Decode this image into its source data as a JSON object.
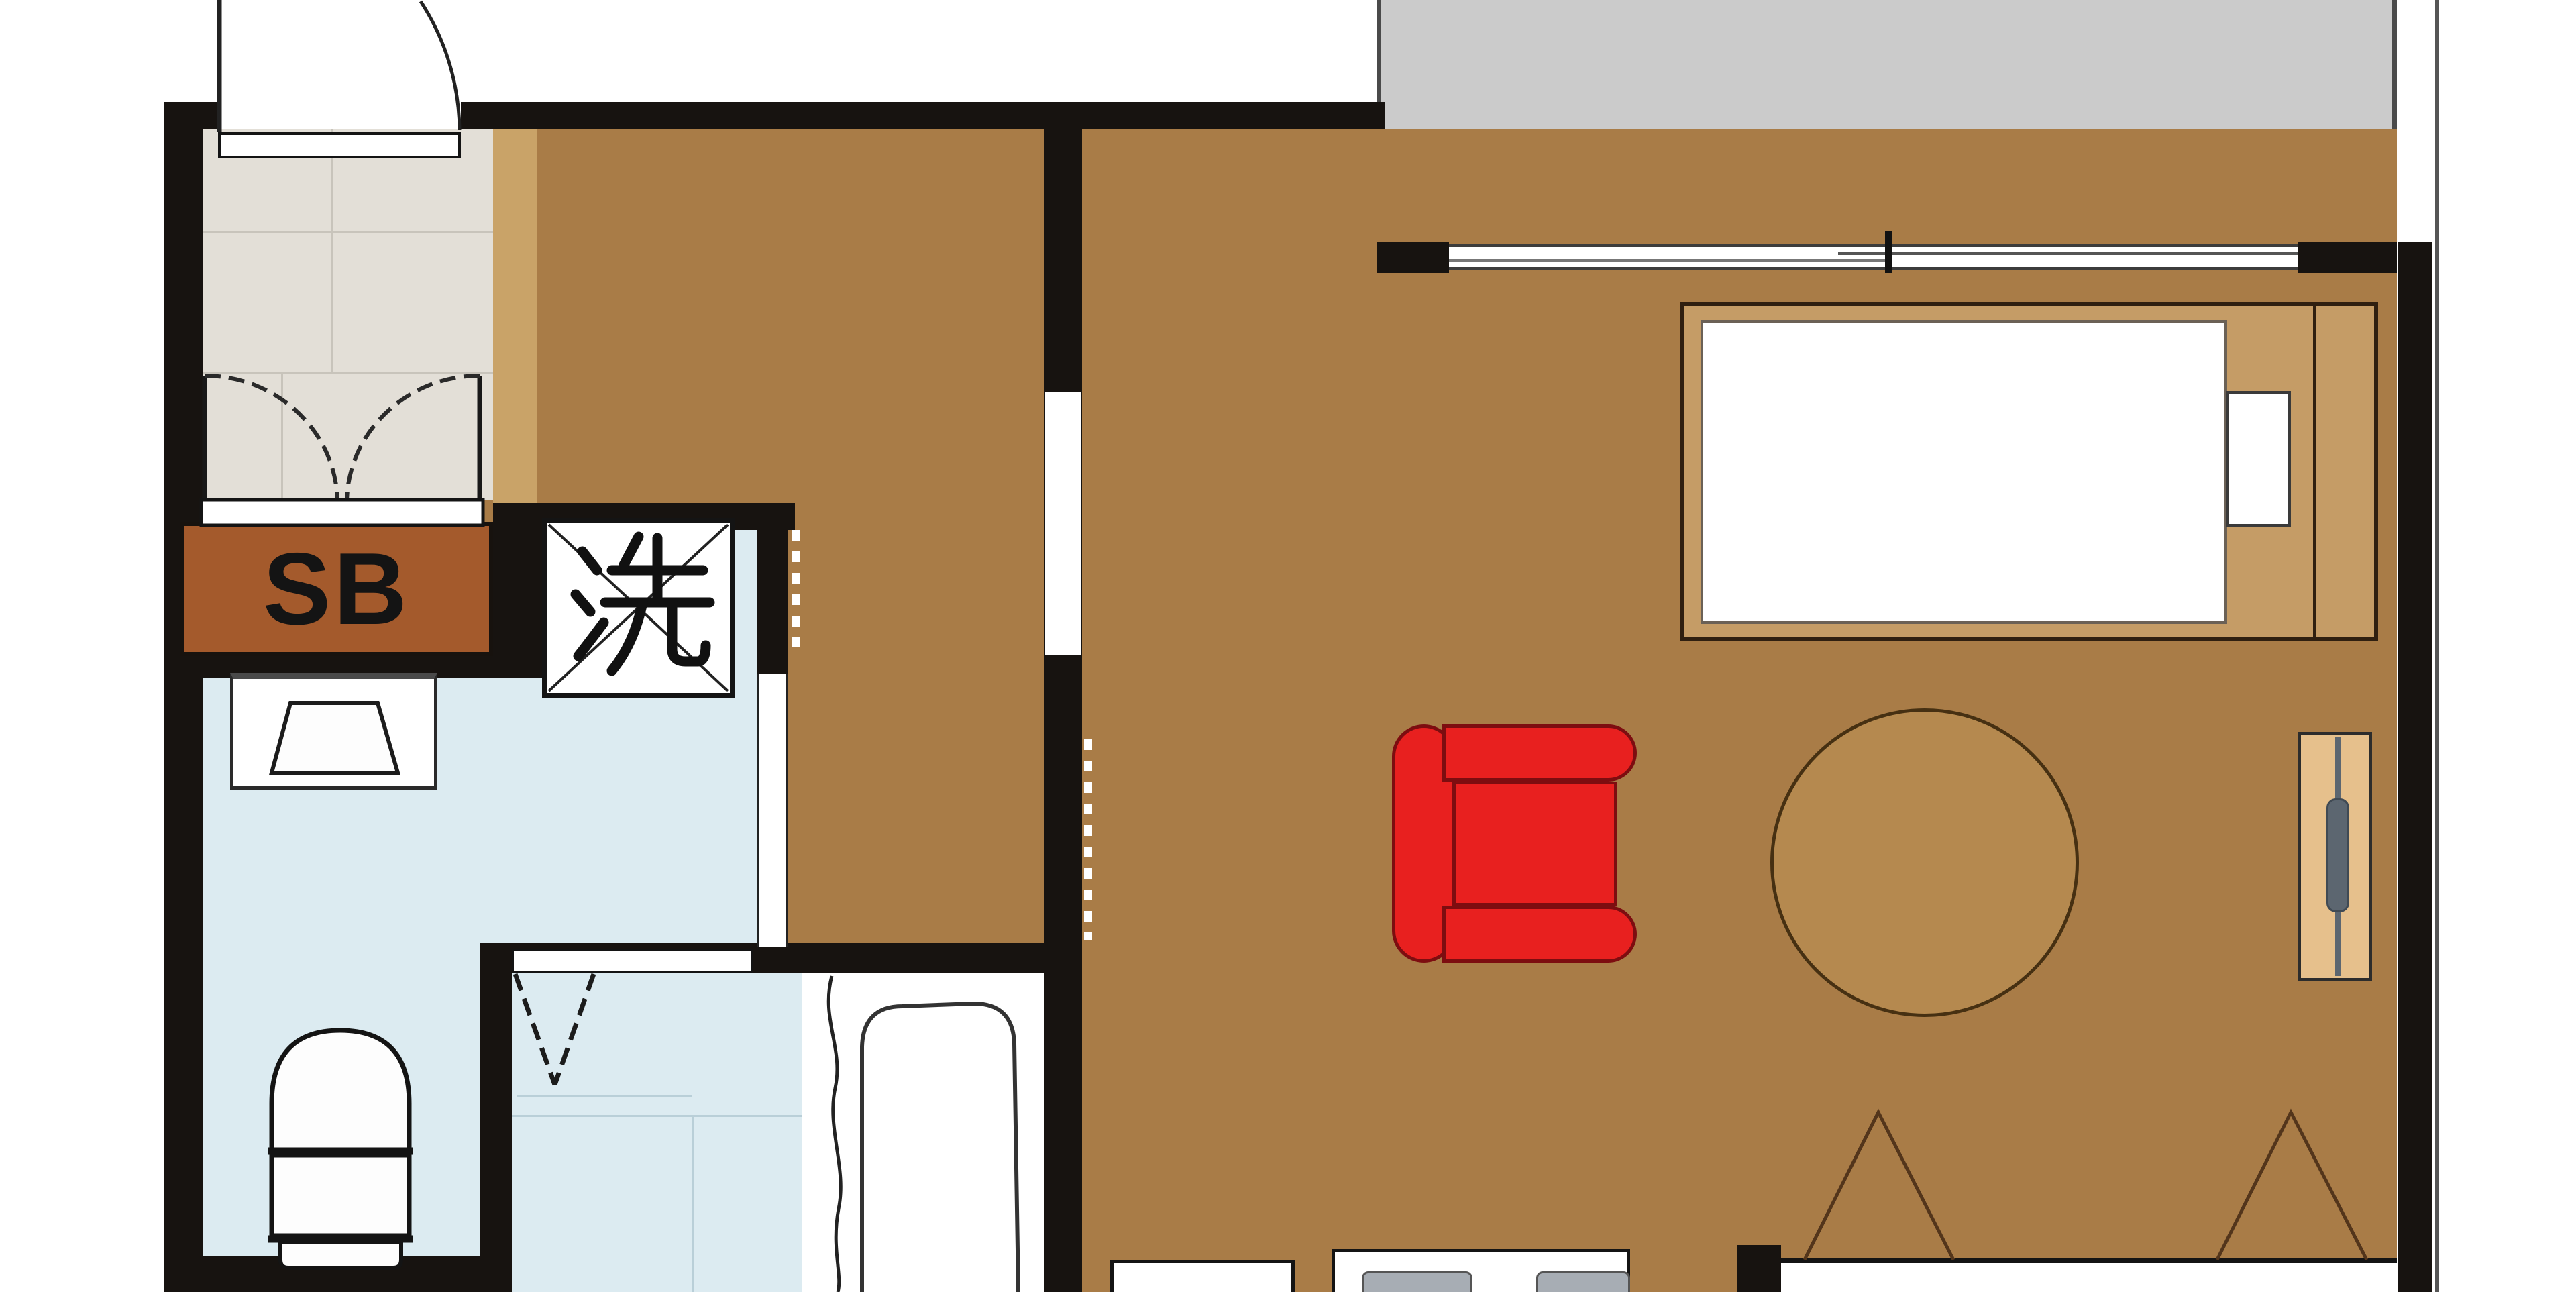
{
  "plan": {
    "type": "apartment-floor-plan",
    "labels": {
      "shoe_box": "SB",
      "washing_machine": "洗"
    },
    "palette": {
      "wall": "#171310",
      "wood_floor": "#a97c47",
      "entrance_tile": "#e3dfd7",
      "tile_grout": "#c8c4bb",
      "entrance_step": "#c9a368",
      "wet_room_floor": "#dcebf1",
      "wet_room_grid": "#b9cfd8",
      "balcony": "#cbcbcb",
      "sofa_red": "#e8201f",
      "sofa_outline": "#7d0d10",
      "shoe_box_fill": "#a45a2c",
      "bed_frame": "#c59c66",
      "table_fill": "#b5894f",
      "tv_board": "#e6c08c",
      "tv_gray": "#5c6670",
      "fixture_white": "#ffffff"
    },
    "icons": [
      "entry-door-swing-icon",
      "double-door-swing-icon",
      "folding-door-icon",
      "sliding-window-icon",
      "closet-triangle-icon",
      "toilet-icon",
      "sink-icon",
      "bathtub-icon",
      "washer-pan-icon",
      "bed-icon",
      "sofa-icon",
      "round-table-icon",
      "tv-board-icon"
    ]
  }
}
